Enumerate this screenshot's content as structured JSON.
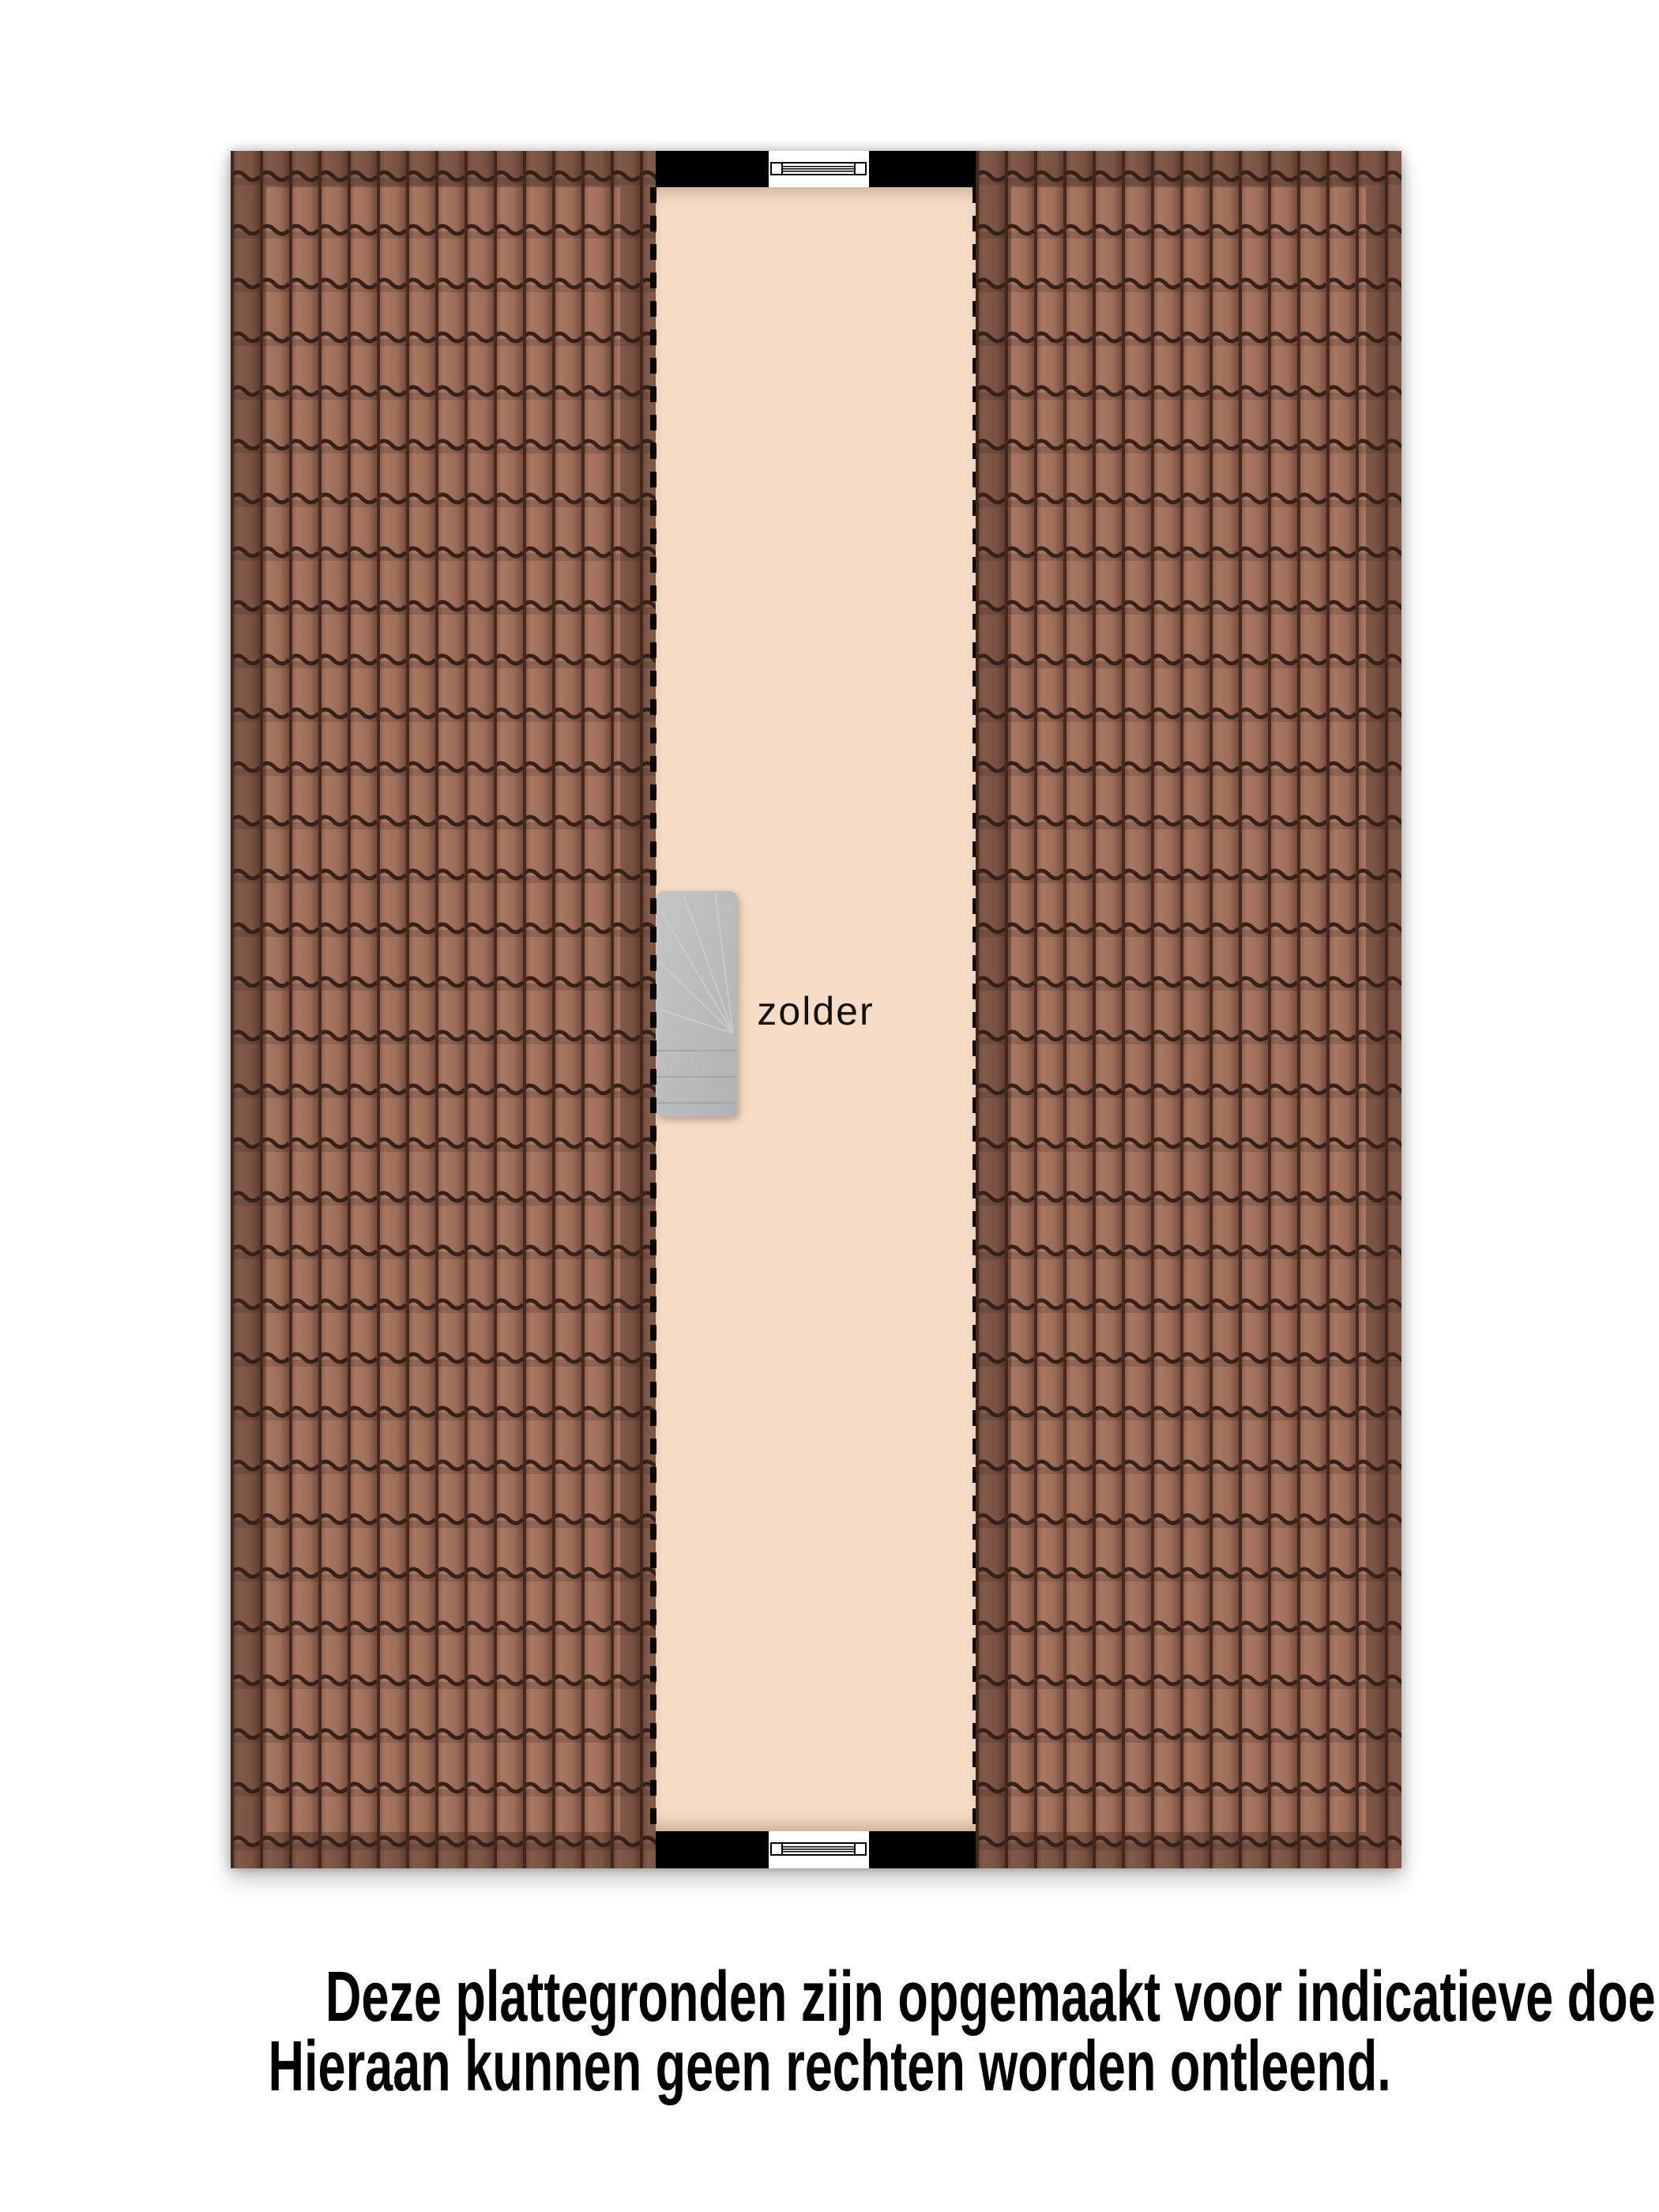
{
  "floorplan": {
    "room_label": "zolder",
    "elements": {
      "stairs_icon": "winder-staircase",
      "window_top_icon": "window-symbol",
      "window_bottom_icon": "window-symbol",
      "roof_left": "tiled-roof-plane",
      "roof_right": "tiled-roof-plane",
      "edge_style": "dashed-roofline"
    },
    "colors": {
      "attic_floor": "#f7ddc5",
      "wall": "#000000",
      "roof_tile": "#a3715d",
      "roof_tile_dark_band": "#7b5141",
      "roof_tile_line": "#33211a",
      "stairs": "#b7b9bb",
      "label_text": "#111111"
    }
  },
  "disclaimer": {
    "line1": "Deze plattegronden zijn opgemaakt voor indicatieve doeleinden.",
    "line2": "Hieraan kunnen geen rechten worden ontleend.",
    "color": "#000000"
  }
}
